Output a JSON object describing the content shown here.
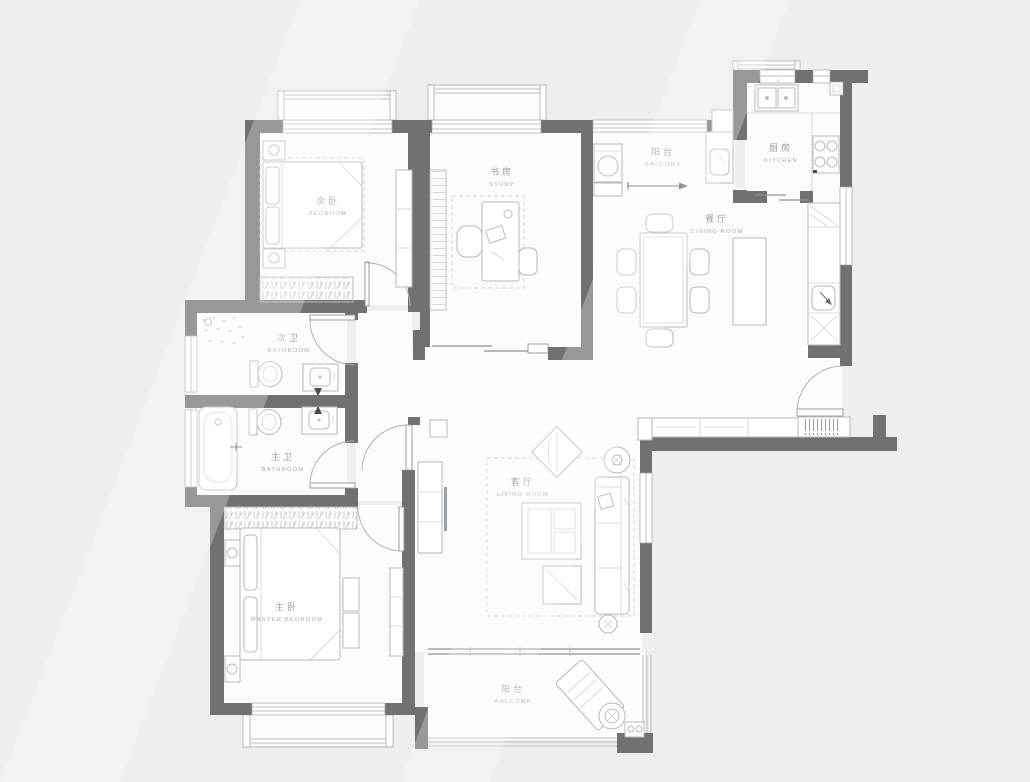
{
  "plan_title": "apartment-floor-plan",
  "rooms": {
    "secondary_bedroom": {
      "cn": "次卧",
      "en": "BEDROOM"
    },
    "study": {
      "cn": "书房",
      "en": "STUDY"
    },
    "balcony_top": {
      "cn": "阳台",
      "en": "BALCONY"
    },
    "kitchen": {
      "cn": "厨房",
      "en": "KITCHEN"
    },
    "dining": {
      "cn": "餐厅",
      "en": "DINING ROOM"
    },
    "guest_bath": {
      "cn": "次卫",
      "en": "BATHROOM"
    },
    "master_bath": {
      "cn": "主卫",
      "en": "BATHROOM"
    },
    "living": {
      "cn": "客厅",
      "en": "LIVING ROOM"
    },
    "master_bedroom": {
      "cn": "主卧",
      "en": "MASTER BEDROOM"
    },
    "balcony_bottom": {
      "cn": "阳台",
      "en": "BALCONY"
    }
  },
  "colors": {
    "wall": "#6f7173",
    "furniture_line": "#b7bcc0",
    "label": "#9aa1a6",
    "floor": "#fbfcfd",
    "background": "#eceef0",
    "fixture_dark": "#4a4d4f"
  },
  "fixtures": [
    "double-bed",
    "wardrobe",
    "bookshelf",
    "desk",
    "washing-machine",
    "kitchen-sink",
    "stove",
    "dining-table",
    "six-chairs",
    "island-counter",
    "toilet",
    "vanity",
    "bathtub",
    "shower",
    "sofa",
    "coffee-table",
    "tv-console",
    "lounge-chair",
    "plant"
  ]
}
